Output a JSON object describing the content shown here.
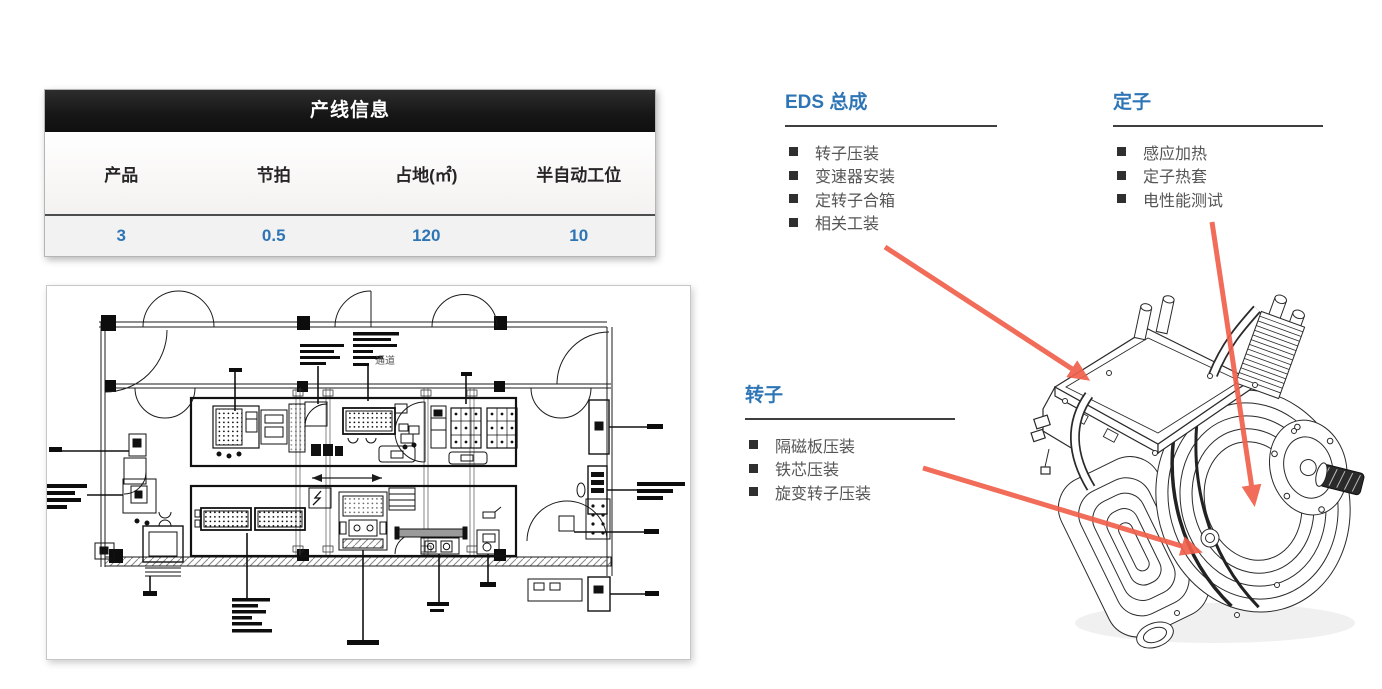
{
  "table": {
    "title": "产线信息",
    "columns": [
      "产品",
      "节拍",
      "占地(㎡)",
      "半自动工位"
    ],
    "values": [
      "3",
      "0.5",
      "120",
      "10"
    ]
  },
  "sections": {
    "eds": {
      "title": "EDS 总成",
      "items": [
        "转子压装",
        "变速器安装",
        "定转子合箱",
        "相关工装"
      ]
    },
    "stator": {
      "title": "定子",
      "items": [
        "感应加热",
        "定子热套",
        "电性能测试"
      ]
    },
    "rotor": {
      "title": "转子",
      "items": [
        "隔磁板压装",
        "铁芯压装",
        "旋变转子压装"
      ]
    }
  },
  "floor_plan": {
    "aisle_label": "通道"
  },
  "colors": {
    "accent_blue": "#2E75B6",
    "arrow_red": "#F0604C",
    "title_bar_black": "#161616",
    "bullet_dark": "#2F2F2F",
    "value_blue": "#2E75B6"
  }
}
